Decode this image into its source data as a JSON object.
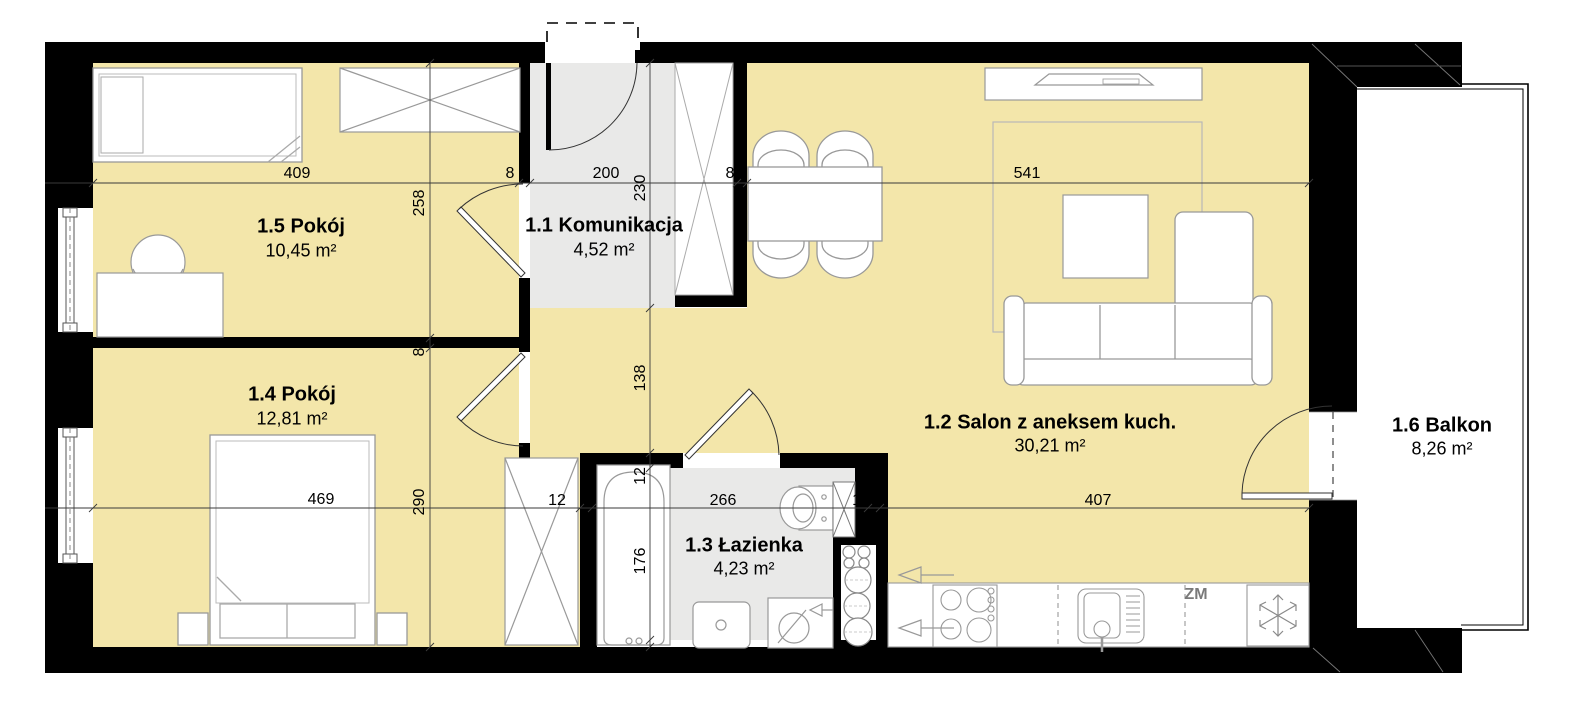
{
  "rooms": {
    "komunikacja": {
      "name": "1.1 Komunikacja",
      "area": "4,52 m²"
    },
    "salon": {
      "name": "1.2 Salon z aneksem kuch.",
      "area": "30,21 m²"
    },
    "lazienka": {
      "name": "1.3 Łazienka",
      "area": "4,23 m²"
    },
    "pokoj_14": {
      "name": "1.4 Pokój",
      "area": "12,81 m²"
    },
    "pokoj_15": {
      "name": "1.5 Pokój",
      "area": "10,45 m²"
    },
    "balkon": {
      "name": "1.6 Balkon",
      "area": "8,26 m²"
    }
  },
  "dimensions": {
    "top_line": {
      "w409": "409",
      "w8_left": "8",
      "w200": "200",
      "w8_right": "8",
      "w541": "541"
    },
    "mid_line": {
      "w469": "469",
      "w12_left": "12",
      "w266": "266",
      "w12_right": "12",
      "w407": "407"
    },
    "v_line_left": {
      "h258": "258",
      "h8": "8",
      "h290": "290"
    },
    "v_line_right": {
      "h230": "230",
      "h138": "138",
      "h12": "12",
      "h176": "176"
    }
  },
  "kitchen": {
    "dishwasher_label": "ZM"
  },
  "colors": {
    "room_floor": "#f3e6aa",
    "hall_floor": "#e9e9e8",
    "wall": "#000000",
    "furniture_stroke": "#999999"
  }
}
